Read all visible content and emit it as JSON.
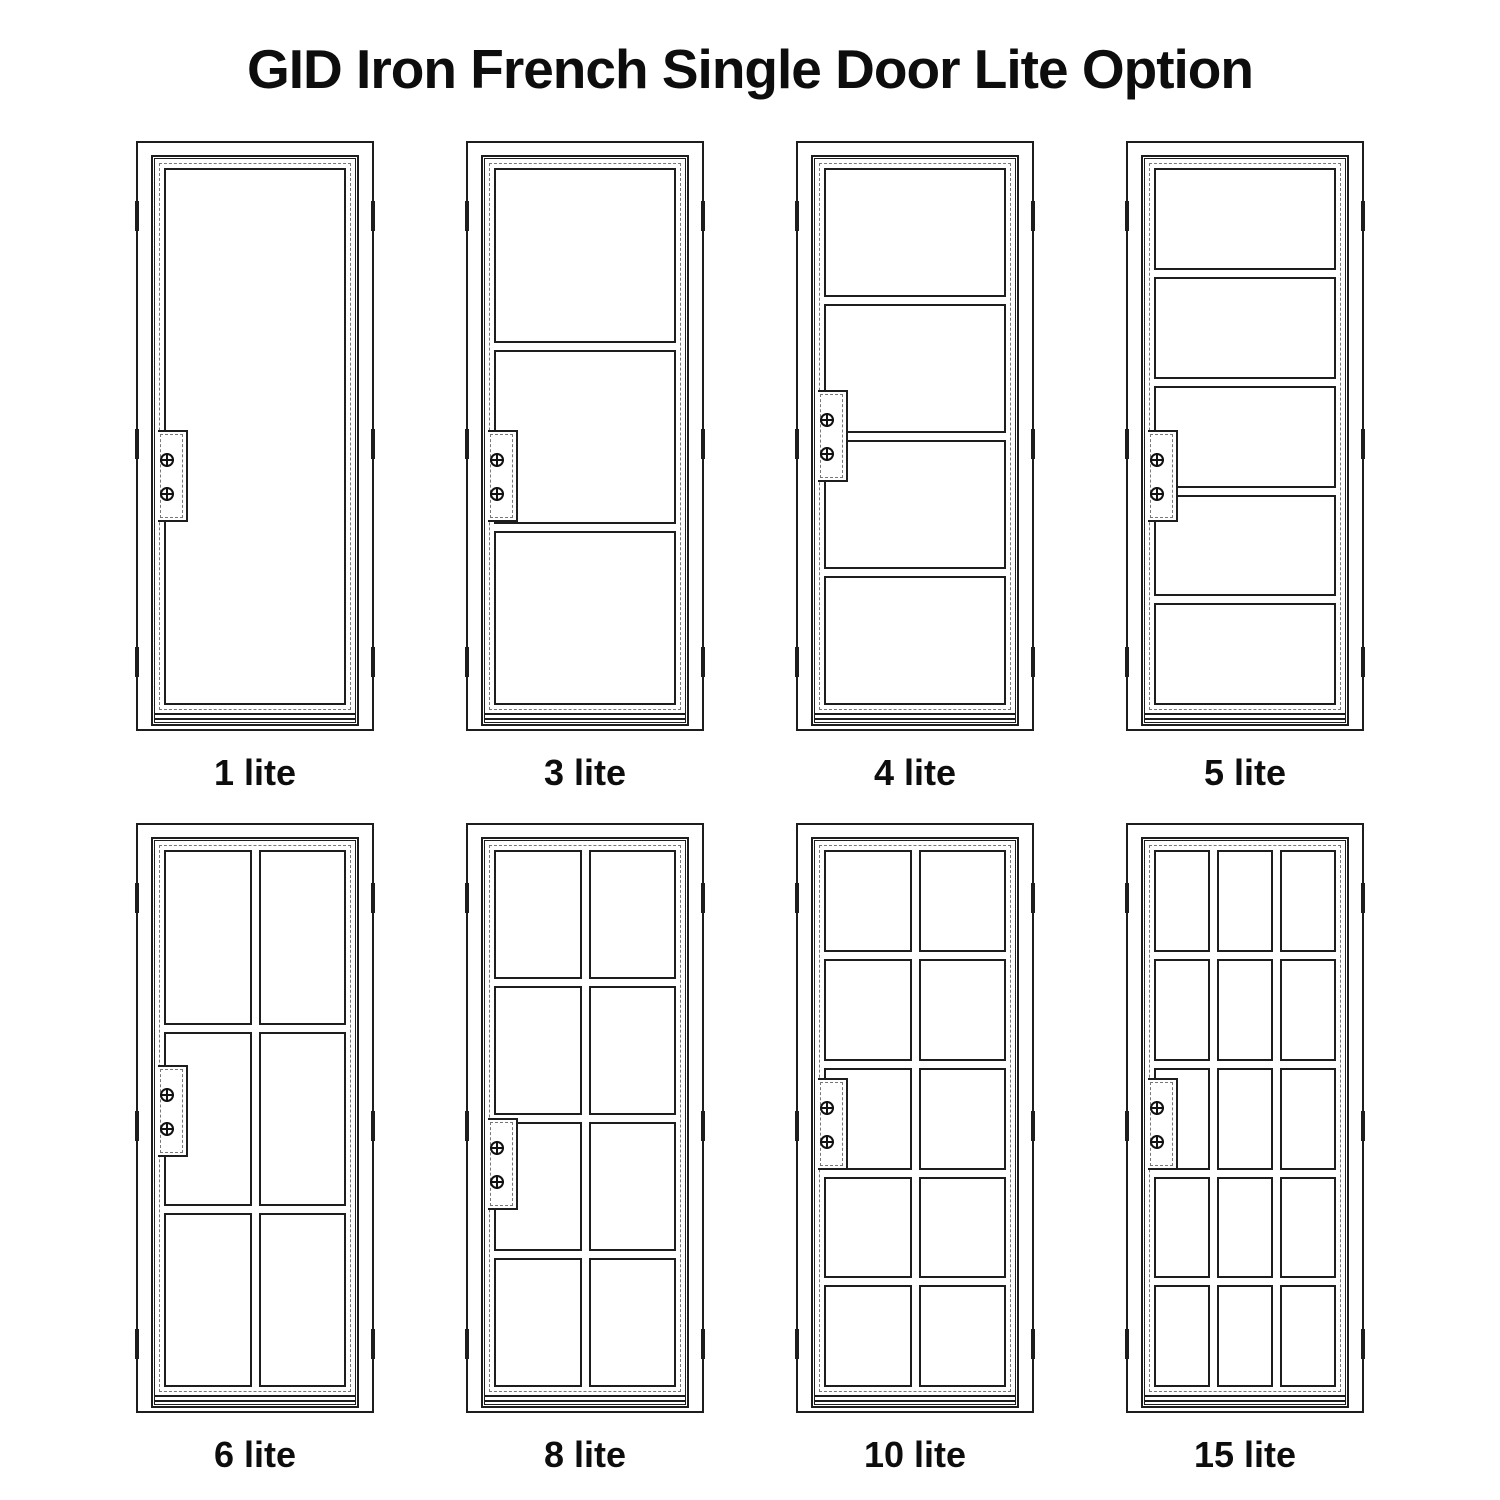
{
  "title": "GID Iron French Single Door Lite Option",
  "doors": [
    {
      "id": "1-lite",
      "label": "1 lite",
      "lites": 1,
      "grid": {
        "rows": 1,
        "cols": 1
      }
    },
    {
      "id": "3-lite",
      "label": "3 lite",
      "lites": 3,
      "grid": {
        "rows": 3,
        "cols": 1
      }
    },
    {
      "id": "4-lite",
      "label": "4 lite",
      "lites": 4,
      "grid": {
        "rows": 4,
        "cols": 1
      }
    },
    {
      "id": "5-lite",
      "label": "5 lite",
      "lites": 5,
      "grid": {
        "rows": 5,
        "cols": 1
      }
    },
    {
      "id": "6-lite",
      "label": "6 lite",
      "lites": 6,
      "grid": {
        "rows": 3,
        "cols": 2
      }
    },
    {
      "id": "8-lite",
      "label": "8 lite",
      "lites": 8,
      "grid": {
        "rows": 4,
        "cols": 2
      }
    },
    {
      "id": "10-lite",
      "label": "10 lite",
      "lites": 10,
      "grid": {
        "rows": 5,
        "cols": 2
      }
    },
    {
      "id": "15-lite",
      "label": "15 lite",
      "lites": 15,
      "grid": {
        "rows": 5,
        "cols": 3
      }
    }
  ],
  "hardware": {
    "screw_icon": "crossed-circle-screw",
    "screws_per_lock_plate": 2,
    "hinge_marks_per_side": 3
  },
  "colors": {
    "line": "#1d1d1d",
    "dash": "#777777",
    "background": "#ffffff",
    "text": "#0d0d0d"
  }
}
